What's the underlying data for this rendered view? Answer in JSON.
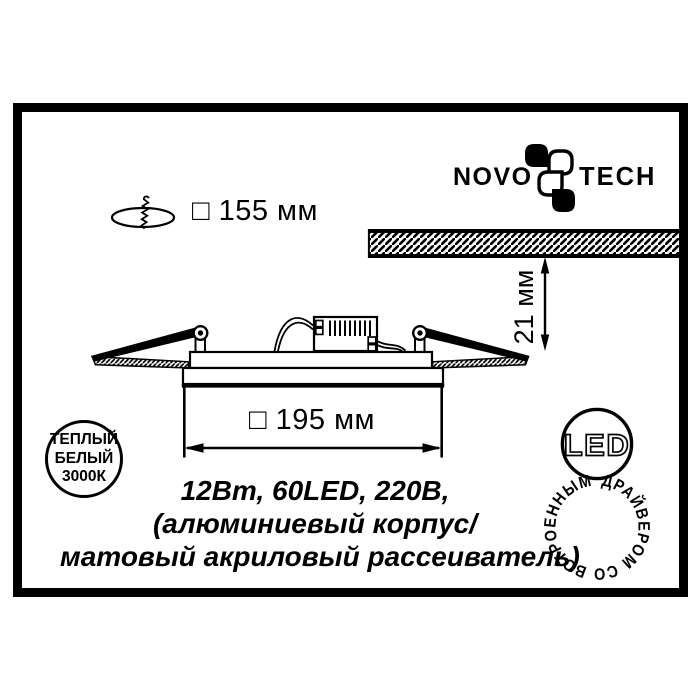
{
  "colors": {
    "ink": "#000000",
    "paper": "#ffffff"
  },
  "brand": {
    "word_left": "NOVO",
    "word_right": "TECH",
    "clover_icon": "novotech-clover-icon"
  },
  "dimensions": {
    "cutout_label": "□ 155 мм",
    "width_label": "□ 195 мм",
    "recess_depth_label": "21 мм"
  },
  "specs": {
    "line1": "12Вт, 60LED, 220В,",
    "line2": "(алюминиевый корпус/",
    "line3": "матовый акриловый рассеиватель)"
  },
  "badges": {
    "warm_white": {
      "line1": "ТЕПЛЫЙ",
      "line2": "БЕЛЫЙ",
      "line3": "3000К"
    },
    "led": {
      "center_label": "LED",
      "ring_label": "ДРАЙВЕРОМ СО ВСТРОЕННЫМ"
    }
  },
  "icons": {
    "cutout": "screw-ceiling-cutout-icon",
    "ceiling": "hatched-ceiling-section",
    "fixture": "recessed-panel-cross-section"
  }
}
